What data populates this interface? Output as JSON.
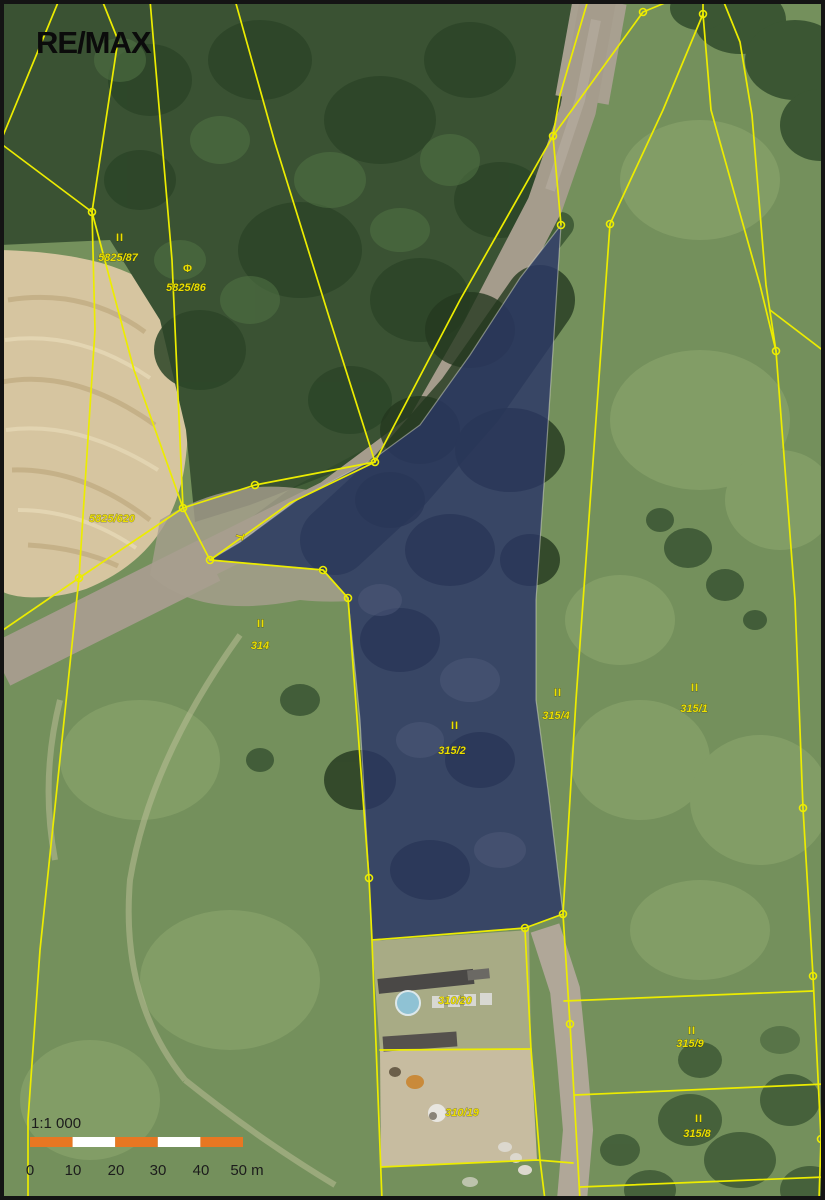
{
  "branding": {
    "logo": "RE/MAX"
  },
  "map": {
    "type": "cadastral-aerial-map",
    "highlight_color": "#2d3487",
    "boundary_color": "#ecec00",
    "parcels": [
      {
        "id": "5825/87",
        "symbol": "II"
      },
      {
        "id": "5825/86",
        "symbol": "Φ"
      },
      {
        "id": "5825/620",
        "symbol": ""
      },
      {
        "id": "314",
        "symbol": "II"
      },
      {
        "id": "315/2",
        "symbol": "II",
        "highlighted": true
      },
      {
        "id": "315/4",
        "symbol": "II"
      },
      {
        "id": "315/1",
        "symbol": "II"
      },
      {
        "id": "310/20",
        "symbol": ""
      },
      {
        "id": "310/19",
        "symbol": ""
      },
      {
        "id": "315/9",
        "symbol": "II"
      },
      {
        "id": "315/8",
        "symbol": "II"
      }
    ],
    "misc_symbols": [
      {
        "glyph": "T",
        "meaning": "boundary-symbol"
      }
    ]
  },
  "scale": {
    "ratio": "1:1 000",
    "ticks": [
      "0",
      "10",
      "20",
      "30",
      "40",
      "50 m"
    ],
    "bar_color": "#e87722"
  }
}
